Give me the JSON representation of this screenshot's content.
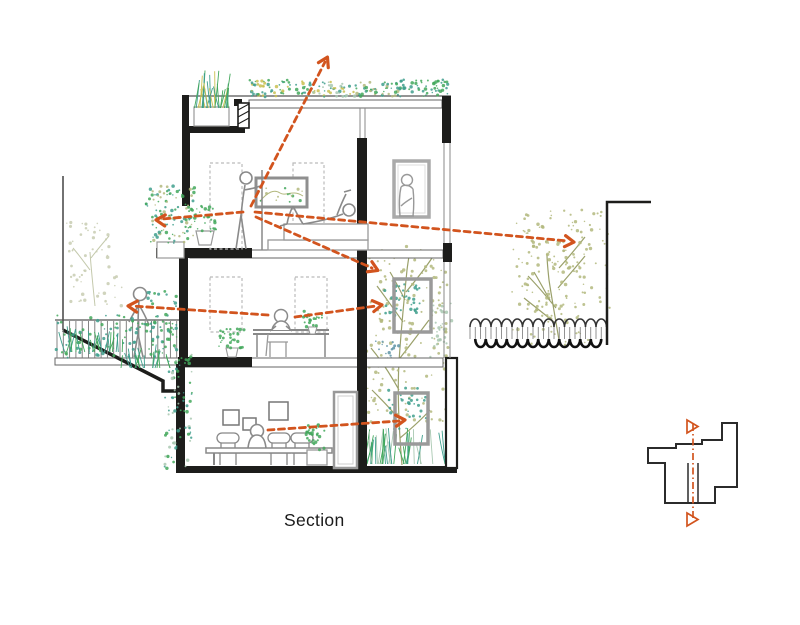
{
  "title": {
    "label": "Section"
  },
  "colors": {
    "background": "#ffffff",
    "accent_orange": "#d2541e",
    "wall_black": "#1d1d1b",
    "structure_gray": "#8f8f8f",
    "teal_green": "#3f9f8d",
    "leaf_green": "#43a85c",
    "olive_green": "#b3b87e",
    "yellow_green": "#c9c050",
    "sage_green": "#a9c8b2",
    "blue_green": "#5e93a4",
    "pale_olive": "#c8cdb2"
  },
  "diagram": {
    "type": "architectural-section-drawing",
    "floors_visible": 3,
    "features": [
      "roof garden with shrubs",
      "top-floor bedroom with standing person and lying person",
      "person in rear window",
      "middle-floor study with person at desk",
      "left balcony with person and railing planting",
      "ground-floor dining room with seated person",
      "interior light well with tall tree and three windows",
      "right courtyard garden with tree",
      "corrugated fence",
      "neighbor boundary walls",
      "sloping site at left"
    ],
    "sight_lines_count": 7,
    "key_plan": {
      "present": true,
      "cut_line": "vertical dash-dot with triangle markers"
    }
  }
}
